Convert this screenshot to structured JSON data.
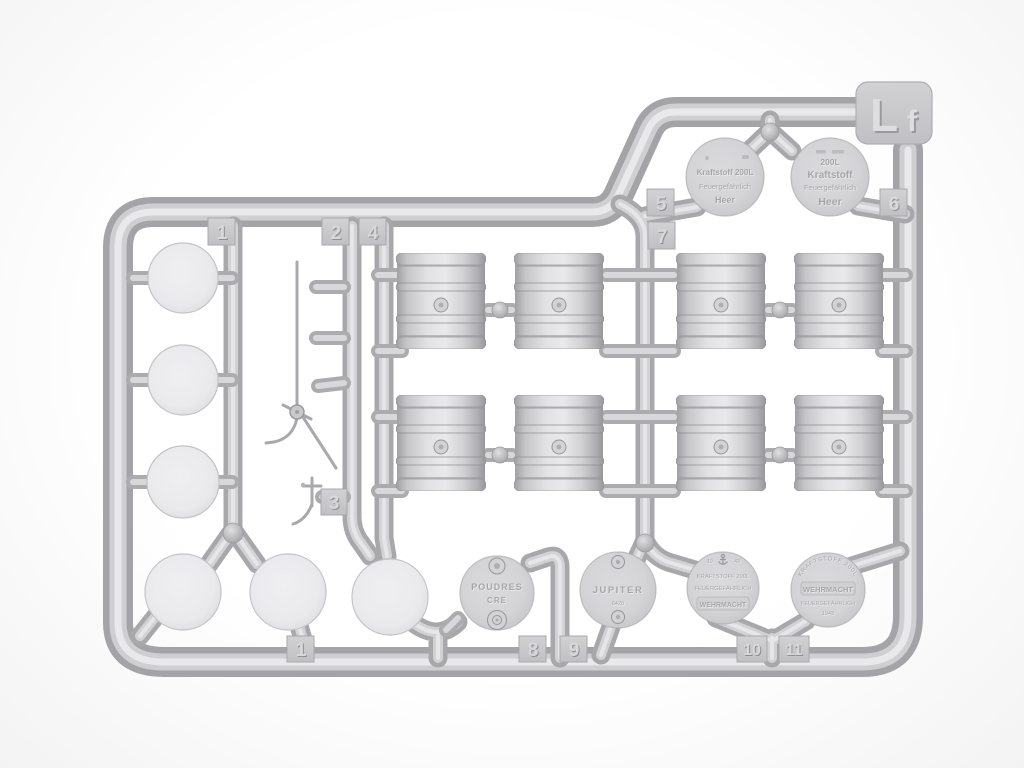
{
  "sprue": {
    "code_main": "L",
    "code_sub": "f"
  },
  "gates": {
    "top_1": "1",
    "top_2": "2",
    "top_3": "3",
    "top_4": "4",
    "top_5": "5",
    "top_6": "6",
    "top_7": "7",
    "bottom_1": "1",
    "bottom_8": "8",
    "bottom_9": "9",
    "bottom_10": "10",
    "bottom_11": "11"
  },
  "lids": {
    "kraftstoff_small": {
      "line1": "Kraftstoff 200L",
      "line2": "Feuergefährlich",
      "line3": "Heer"
    },
    "kraftstoff_large": {
      "line1": "200L",
      "line2": "Kraftstoff",
      "line3": "Feuergefährlich",
      "line4": "Heer"
    },
    "poudres": {
      "line1": "POUDRES",
      "line2": "CRE"
    },
    "jupiter": {
      "line1": "JUPITER",
      "line2": "6420"
    },
    "kriegsmarine": {
      "year_left": "19",
      "year_right": "43",
      "line1": "KRAFTSTOFF 200L",
      "line2": "FEUERGEFÄHRLICH",
      "line3": "WEHRMACHT"
    },
    "wehrmacht_1943": {
      "arc": "KRAFTSTOFF 200L",
      "line1": "WEHRMACHT",
      "line2": "FEUERGEFÄHRLICH",
      "line3": "1943"
    }
  },
  "colors": {
    "plastic_base": "#d2d2d5",
    "plastic_shadow": "#a6a6aa",
    "plastic_highlight": "#e9e9ec",
    "background": "#f7f7f8"
  }
}
